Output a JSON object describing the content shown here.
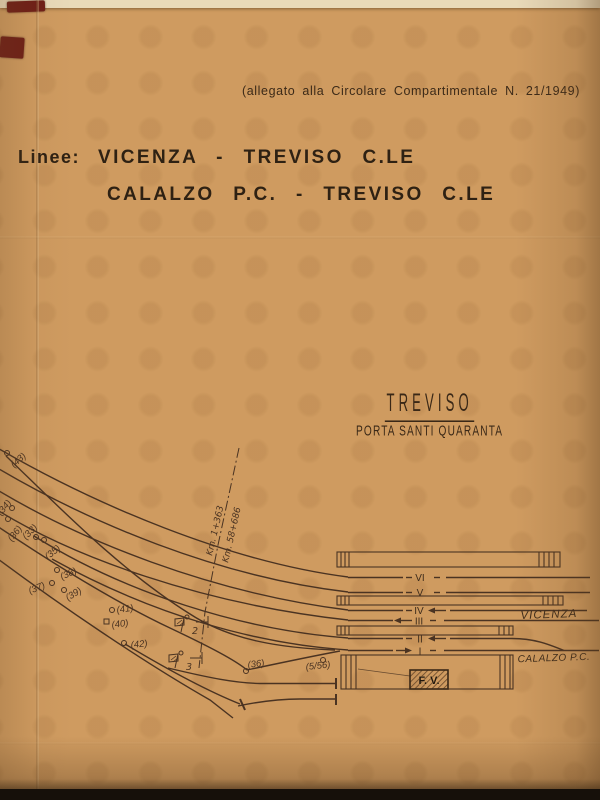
{
  "note": {
    "text": "(allegato alla Circolare Compartimentale N. 21/1949)"
  },
  "title": {
    "label": "Linee:",
    "line1": "VICENZA - TREVISO C.LE",
    "line2": "CALALZO P.C. - TREVISO C.LE"
  },
  "station": {
    "name": "TREVISO",
    "subtitle": "PORTA SANTI QUARANTA"
  },
  "diagram": {
    "km_upper": "Km. 1+363",
    "km_lower": "Km. 58+686",
    "dest_right_upper": "VICENZA",
    "dest_right_lower": "CALALZO P.C.",
    "building_label": "F. V.",
    "tracks": {
      "t6": "VI",
      "t5": "V",
      "t4": "IV",
      "t3": "III",
      "t2": "II",
      "t1": "I"
    },
    "switches": {
      "s43": "(43)",
      "s34": "(34)",
      "s36_left": "(36)",
      "s33": "(33)",
      "s35": "(35)",
      "s38": "(38)",
      "s37": "(37)",
      "s39": "(39)",
      "s41": "(41)",
      "s40": "(40)",
      "s42": "(42)",
      "s36_scalo": "(36)",
      "s5_56": "(5/56)"
    },
    "signals": {
      "sig2": "2",
      "sig3": "3"
    }
  },
  "colors": {
    "paper": "#cf9b60",
    "ink": "#46321f",
    "title_ink": "#2e2113",
    "maroon": "#6f1f17"
  }
}
